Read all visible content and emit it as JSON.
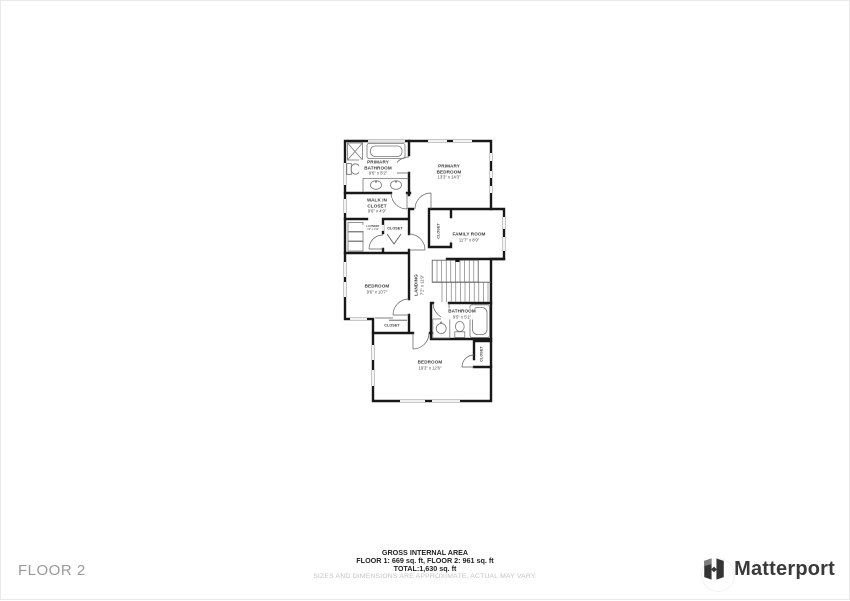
{
  "page": {
    "floor_label": "FLOOR 2"
  },
  "footer": {
    "title": "GROSS INTERNAL AREA",
    "floors": "FLOOR 1: 669 sq. ft, FLOOR 2: 961 sq. ft",
    "total": "TOTAL:1,630 sq. ft",
    "disclaimer": "SIZES AND DIMENSIONS ARE APPROXIMATE, ACTUAL MAY VARY."
  },
  "brand": {
    "name": "Matterport"
  },
  "rooms": {
    "primary_bathroom": {
      "name": "PRIMARY BATHROOM",
      "dims": "9'6\" x 8'2\""
    },
    "primary_bedroom": {
      "name": "PRIMARY BEDROOM",
      "dims": "13'3\" x 14'3\""
    },
    "walk_in_closet": {
      "name": "WALK IN CLOSET",
      "dims": "9'6\" x 4'9\""
    },
    "laundry": {
      "name": "LAUNDRY",
      "dims": "3'0\" x 4'10\""
    },
    "hall_closet": {
      "name": "CLOSET"
    },
    "family_closet": {
      "name": "CLOSET"
    },
    "family_room": {
      "name": "FAMILY ROOM",
      "dims": "11'7\" x 8'9\""
    },
    "landing": {
      "name": "LANDING",
      "dims": "7'2\" x 11'9\""
    },
    "bedroom_mid": {
      "name": "BEDROOM",
      "dims": "9'6\" x 10'7\""
    },
    "bedroom_closet": {
      "name": "CLOSET"
    },
    "bathroom": {
      "name": "BATHROOM",
      "dims": "9'5\" x 5'1\""
    },
    "bottom_closet": {
      "name": "CLOSET"
    },
    "bedroom_bottom": {
      "name": "BEDROOM",
      "dims": "19'3\" x 12'6\""
    }
  },
  "colors": {
    "wall": "#181818",
    "window": "#8f8f8f",
    "fixture": "#767676"
  }
}
